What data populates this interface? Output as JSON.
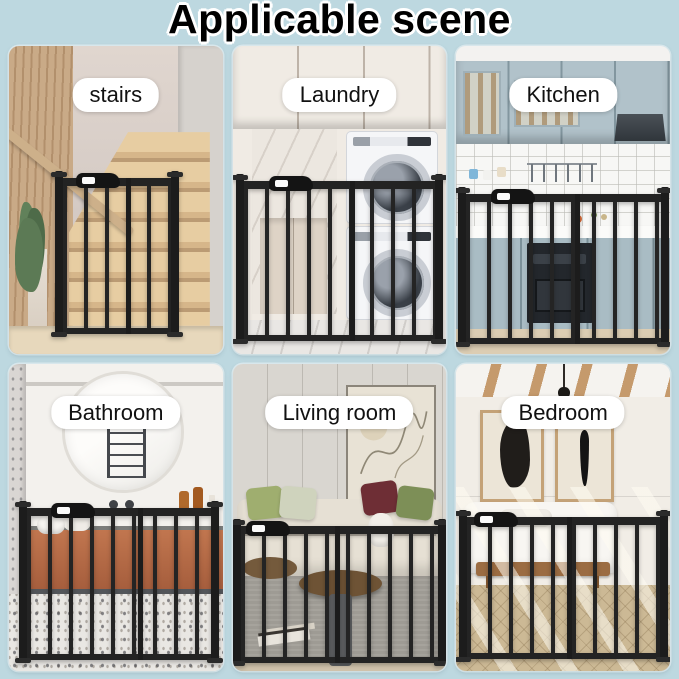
{
  "title": "Applicable scene",
  "colors": {
    "background": "#bdd8e0",
    "gate": "#232323",
    "label_bg": "#ffffff",
    "label_text": "#111111",
    "title_text": "#000000",
    "title_outline": "#ffffff"
  },
  "scenes": [
    {
      "id": "stairs",
      "label": "stairs"
    },
    {
      "id": "laundry",
      "label": "Laundry"
    },
    {
      "id": "kitchen",
      "label": "Kitchen"
    },
    {
      "id": "bathroom",
      "label": "Bathroom"
    },
    {
      "id": "living-room",
      "label": "Living room"
    },
    {
      "id": "bedroom",
      "label": "Bedroom"
    }
  ]
}
